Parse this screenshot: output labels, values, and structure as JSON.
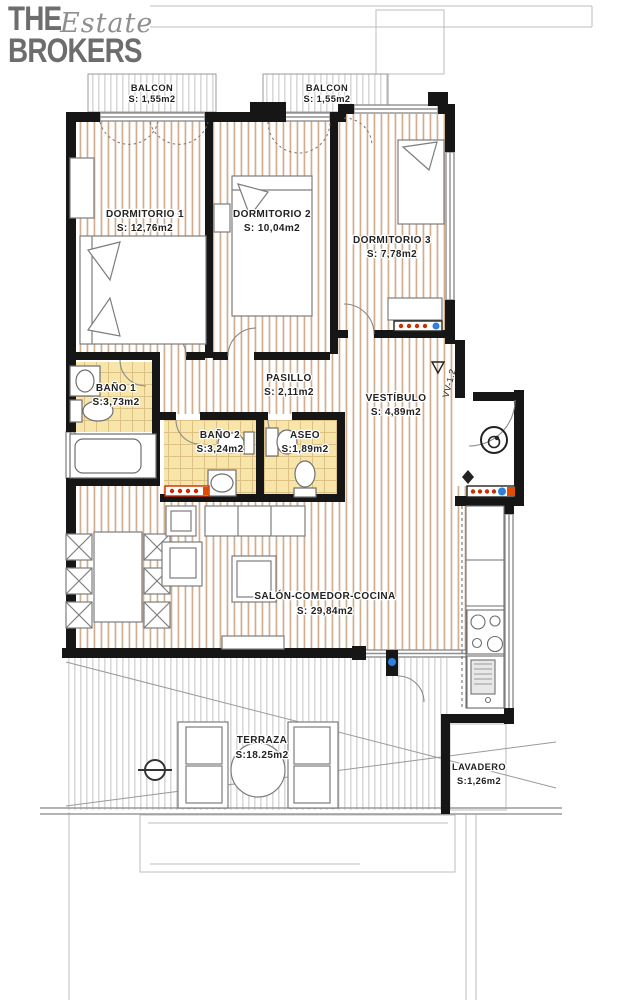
{
  "brand": {
    "the": "THE",
    "estate": "Estate",
    "brokers": "BROKERS"
  },
  "rooms": [
    {
      "id": "balcon-1",
      "name": "BALCON",
      "area": "S: 1,55m2"
    },
    {
      "id": "balcon-2",
      "name": "BALCON",
      "area": "S: 1,55m2"
    },
    {
      "id": "dormitorio-1",
      "name": "DORMITORIO 1",
      "area": "S: 12,76m2"
    },
    {
      "id": "dormitorio-2",
      "name": "DORMITORIO 2",
      "area": "S: 10,04m2"
    },
    {
      "id": "dormitorio-3",
      "name": "DORMITORIO 3",
      "area": "S: 7,78m2"
    },
    {
      "id": "bano-1",
      "name": "BAÑO 1",
      "area": "S:3,73m2"
    },
    {
      "id": "pasillo",
      "name": "PASILLO",
      "area": "S: 2,11m2"
    },
    {
      "id": "vestibulo",
      "name": "VESTÍBULO",
      "area": "S: 4,89m2"
    },
    {
      "id": "bano-2",
      "name": "BAÑO 2",
      "area": "S:3,24m2"
    },
    {
      "id": "aseo",
      "name": "ASEO",
      "area": "S:1,89m2"
    },
    {
      "id": "salon",
      "name": "SALÓN-COMEDOR-COCINA",
      "area": "S: 29,84m2"
    },
    {
      "id": "terraza",
      "name": "TERRAZA",
      "area": "S:18.25m2"
    },
    {
      "id": "lavadero",
      "name": "LAVADERO",
      "area": "S:1,26m2"
    }
  ],
  "markers": {
    "entry_window_code": "VV-1.2"
  },
  "colors": {
    "wall": "#161616",
    "thin_line": "#8f8f8f",
    "wood_strip": "#c49a72",
    "tile_bg": "#f7e5aa",
    "tile_line": "#ddc184",
    "terrace_hatch": "#c9c9c9",
    "radiator_red": "#cc2e00",
    "radiator_blue": "#2e7fe0",
    "radiator_orange": "#e04d00",
    "logo_gray": "#6d6d6d",
    "label_text": "#222222"
  }
}
